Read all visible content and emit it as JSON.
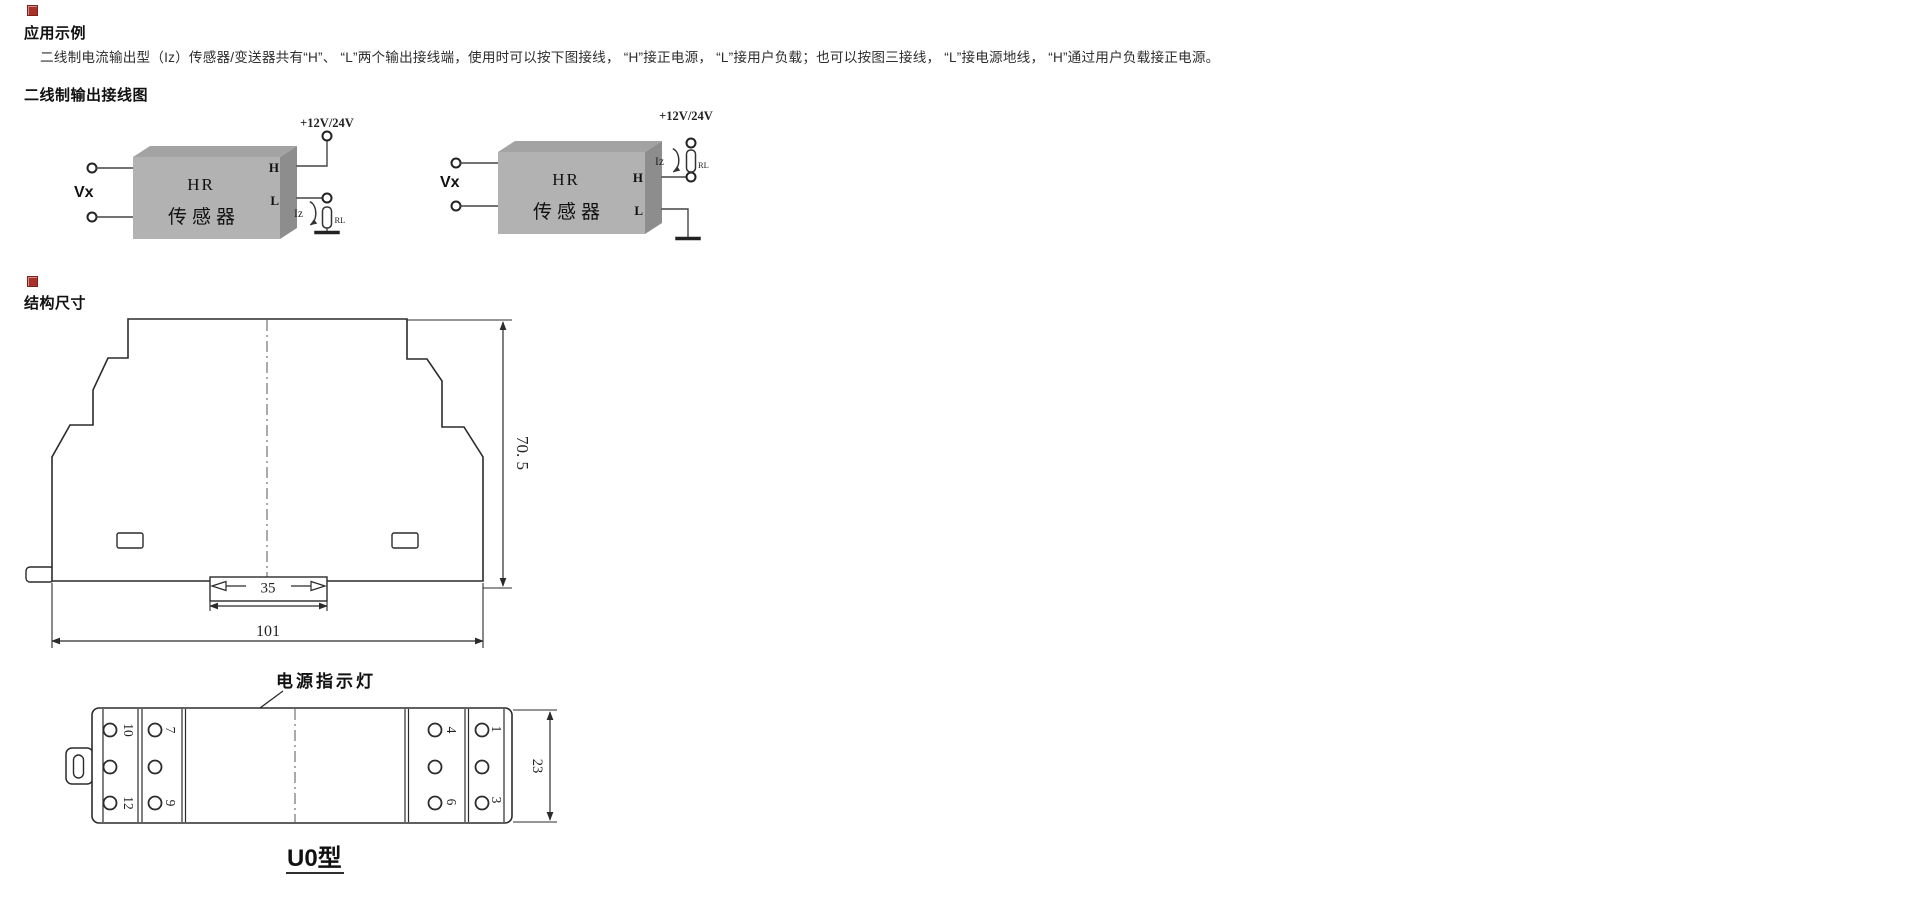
{
  "sections": {
    "application": {
      "title": "应用示例",
      "paragraph": "二线制电流输出型（Iz）传感器/变送器共有“H”、 “L”两个输出接线端，使用时可以按下图接线， “H”接正电源， “L”接用户负载；也可以按图三接线， “L”接电源地线， “H”通过用户负载接正电源。",
      "wiring_heading": "二线制输出接线图"
    },
    "structure": {
      "title": "结构尺寸",
      "dim_height": "70. 5",
      "dim_width": "101",
      "dim_rail": "35"
    }
  },
  "wiring": {
    "supply_label": "+12V/24V",
    "input_label": "Vx",
    "box_title": "HR",
    "box_subtitle": "传感器",
    "terminal_h": "H",
    "terminal_l": "L",
    "current_label": "Iz",
    "load_label": "RL"
  },
  "bottom_view": {
    "led_label": "电源指示灯",
    "dim_depth": "23",
    "model_label": "U0型",
    "terminals": {
      "left_outer_top": "10",
      "left_inner_top": "7",
      "left_outer_bottom": "12",
      "left_inner_bottom": "9",
      "right_inner_top": "4",
      "right_outer_top": "1",
      "right_inner_bottom": "6",
      "right_outer_bottom": "3"
    }
  },
  "colors": {
    "section_marker": "#a8322a",
    "line_art": "#2b2b2b",
    "box_face": "#b2b2b2",
    "box_top": "#a3a3a3",
    "box_side": "#8d8d8d",
    "background": "#ffffff"
  }
}
